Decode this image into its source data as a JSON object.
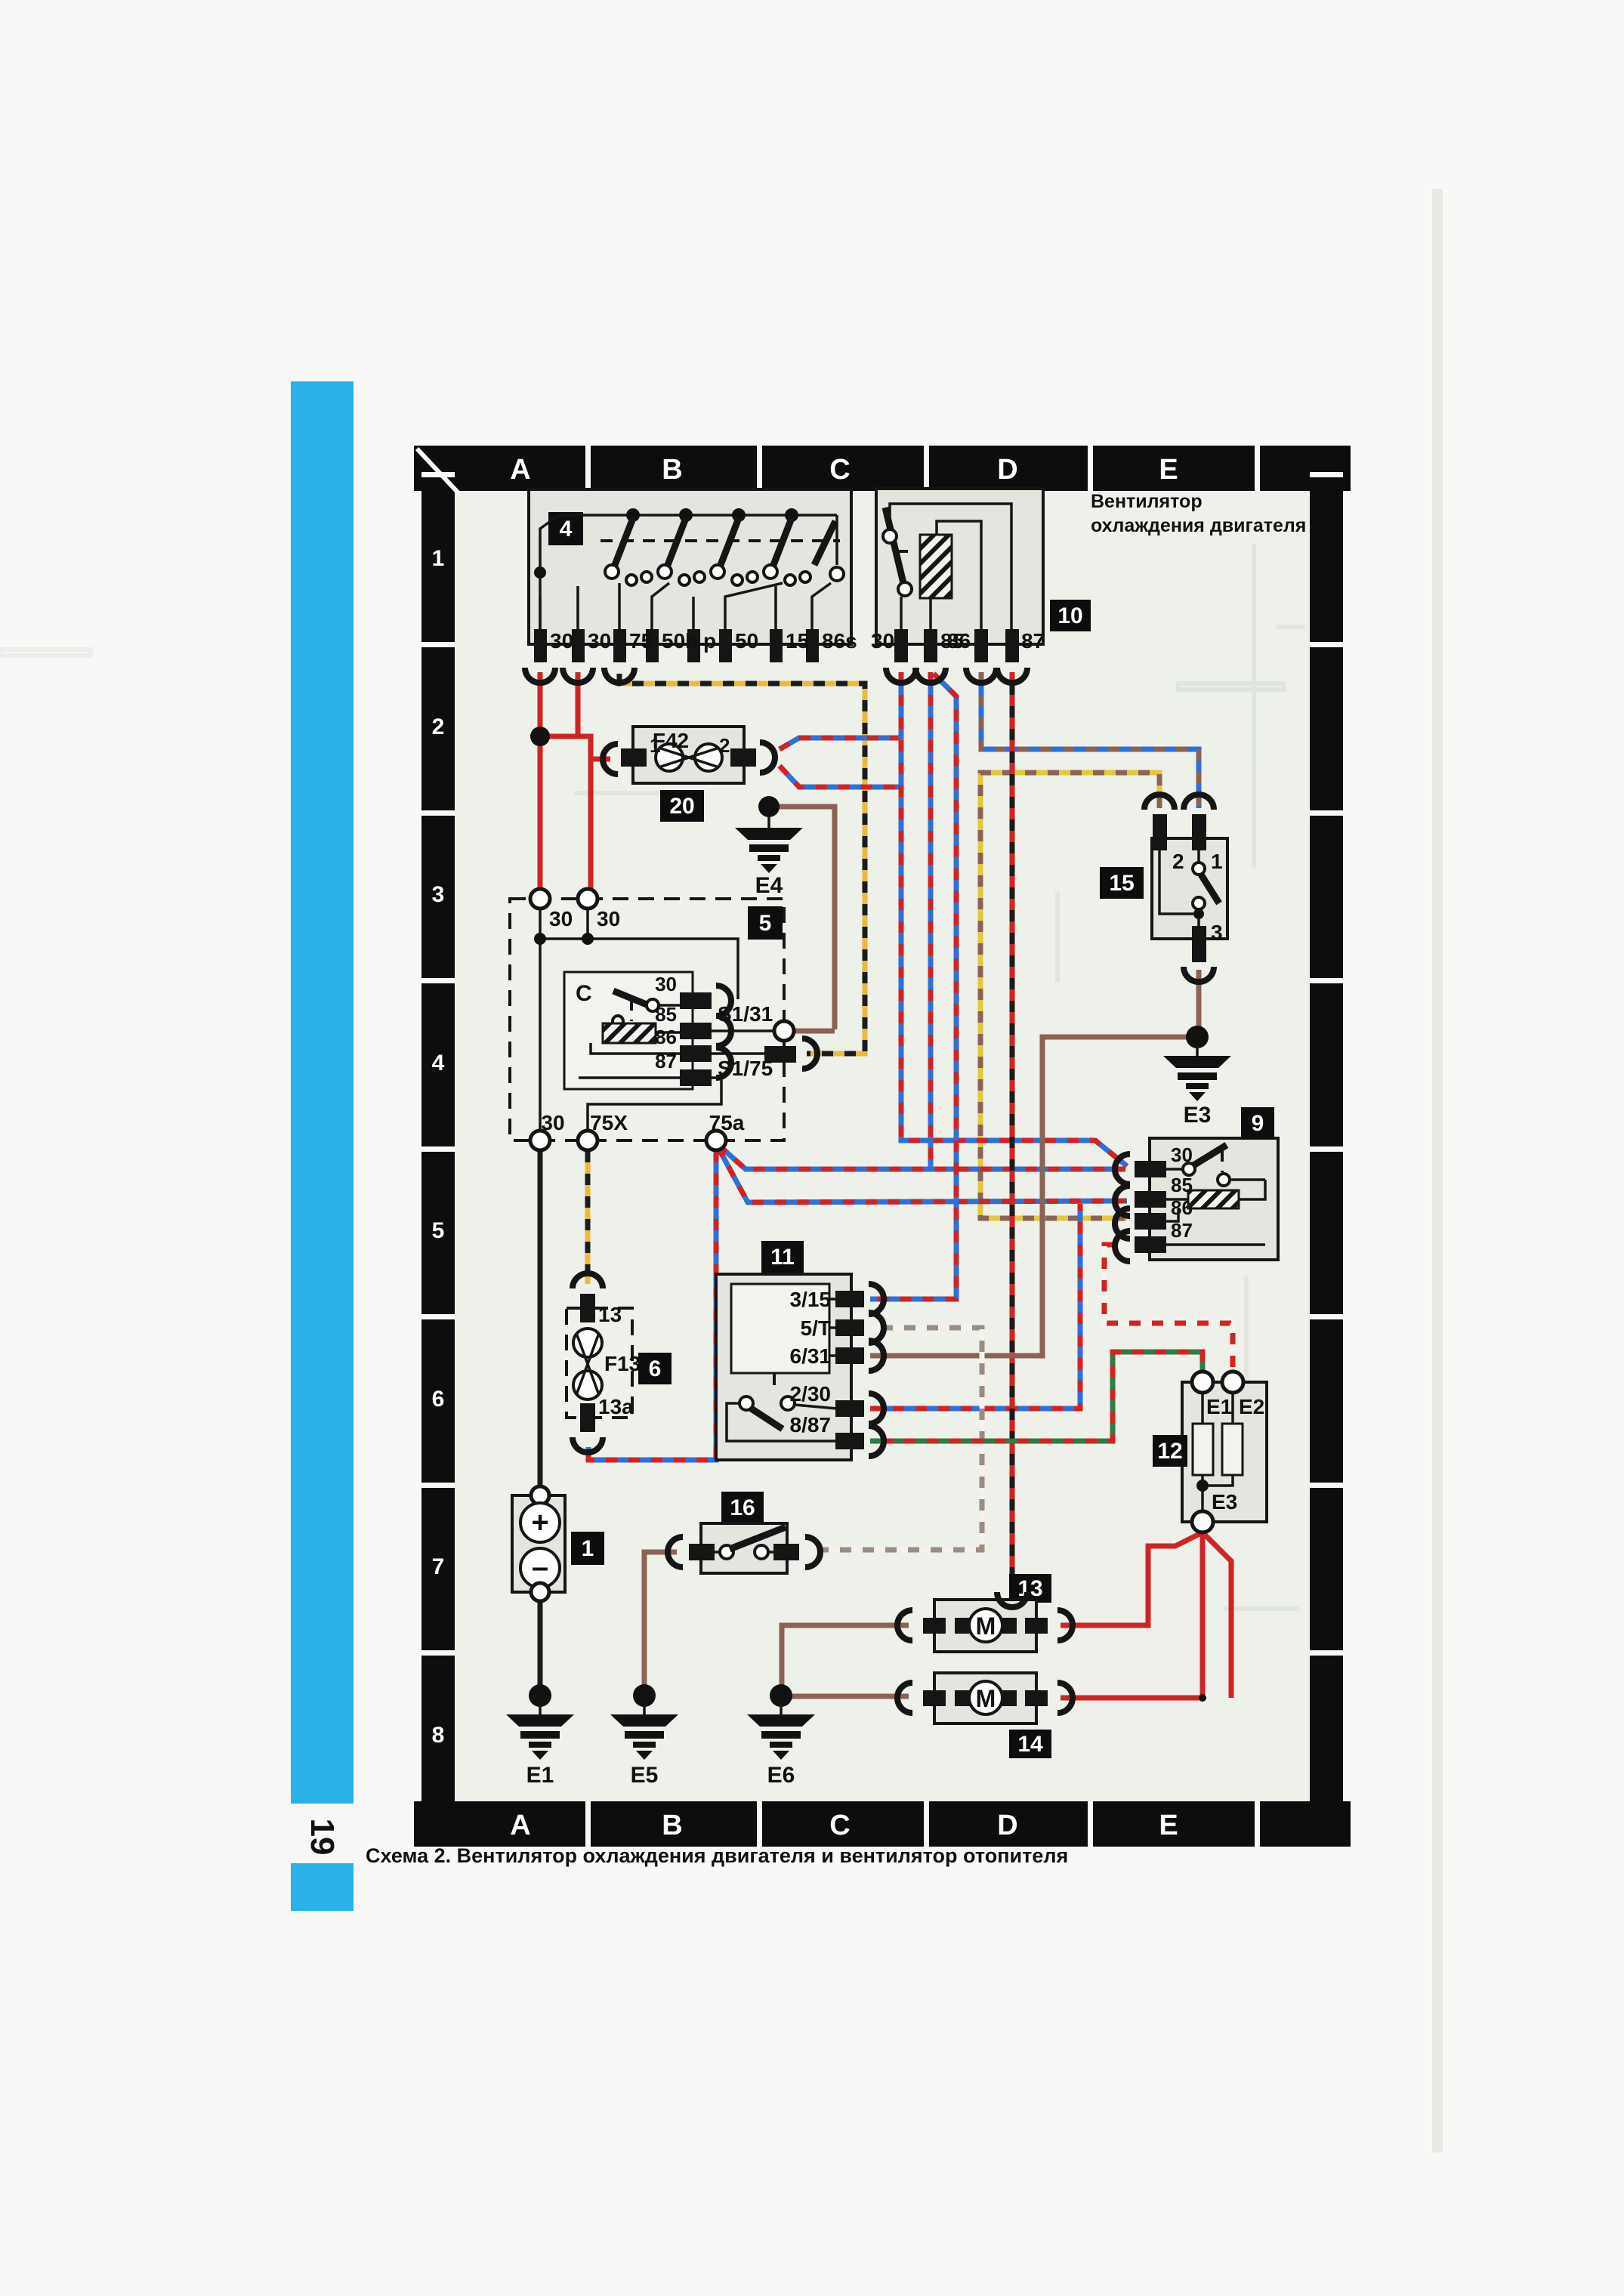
{
  "page": {
    "number": "19",
    "caption": "Схема 2. Вентилятор охлаждения двигателя и вентилятор отопителя",
    "annotation1": "Вентилятор",
    "annotation2": "охлаждения двигателя"
  },
  "grid": {
    "cols": [
      "A",
      "B",
      "C",
      "D",
      "E"
    ],
    "rows": [
      "1",
      "2",
      "3",
      "4",
      "5",
      "6",
      "7",
      "8"
    ]
  },
  "c1": {
    "badge": "1",
    "plus": "+",
    "minus": "–"
  },
  "c4": {
    "badge": "4",
    "t": [
      "30",
      "30",
      "75",
      "50b",
      "p",
      "50",
      "15",
      "86s"
    ]
  },
  "c5": {
    "badge": "5",
    "top0": "30",
    "top1": "30",
    "c": "C",
    "r30": "30",
    "r85": "85",
    "r86": "86",
    "r87": "87",
    "s131": "S1/31",
    "s175": "S1/75",
    "b30": "30",
    "b75x": "75X",
    "b75a": "75a"
  },
  "c6": {
    "badge": "6",
    "top": "13",
    "fuse": "F13",
    "bottom": "13a"
  },
  "c9": {
    "badge": "9",
    "t30": "30",
    "t85": "85",
    "t86": "86",
    "t87": "87"
  },
  "c10": {
    "badge": "10",
    "t30": "30",
    "t85": "85",
    "t86": "86",
    "t87": "87"
  },
  "c11": {
    "badge": "11",
    "t0": "3/15",
    "t1": "5/T",
    "t2": "6/31",
    "t3": "2/30",
    "t4": "8/87"
  },
  "c12": {
    "badge": "12",
    "e1": "E1",
    "e2": "E2",
    "e3": "E3"
  },
  "c13": {
    "badge": "13",
    "m": "M"
  },
  "c14": {
    "badge": "14",
    "m": "M"
  },
  "c15": {
    "badge": "15",
    "t1": "1",
    "t2": "2",
    "t3": "3"
  },
  "c16": {
    "badge": "16"
  },
  "c20": {
    "badge": "20",
    "fuse": "F42",
    "t1": "1",
    "t2": "2"
  },
  "grounds": {
    "e1": "E1",
    "e3": "E3",
    "e4": "E4",
    "e5": "E5",
    "e6": "E6"
  },
  "colors": {
    "red": "#cf2424",
    "black": "#1b1b1b",
    "blue": "#2f6fd8",
    "brown": "#8a6355",
    "yellow": "#eaba3d",
    "yellow2": "#e3c83f",
    "grey_brown": "#9b8b80",
    "green": "#2e7d46",
    "white": "#f4f2ee",
    "dark": "#222222",
    "cyan": "#2cb0e8"
  }
}
